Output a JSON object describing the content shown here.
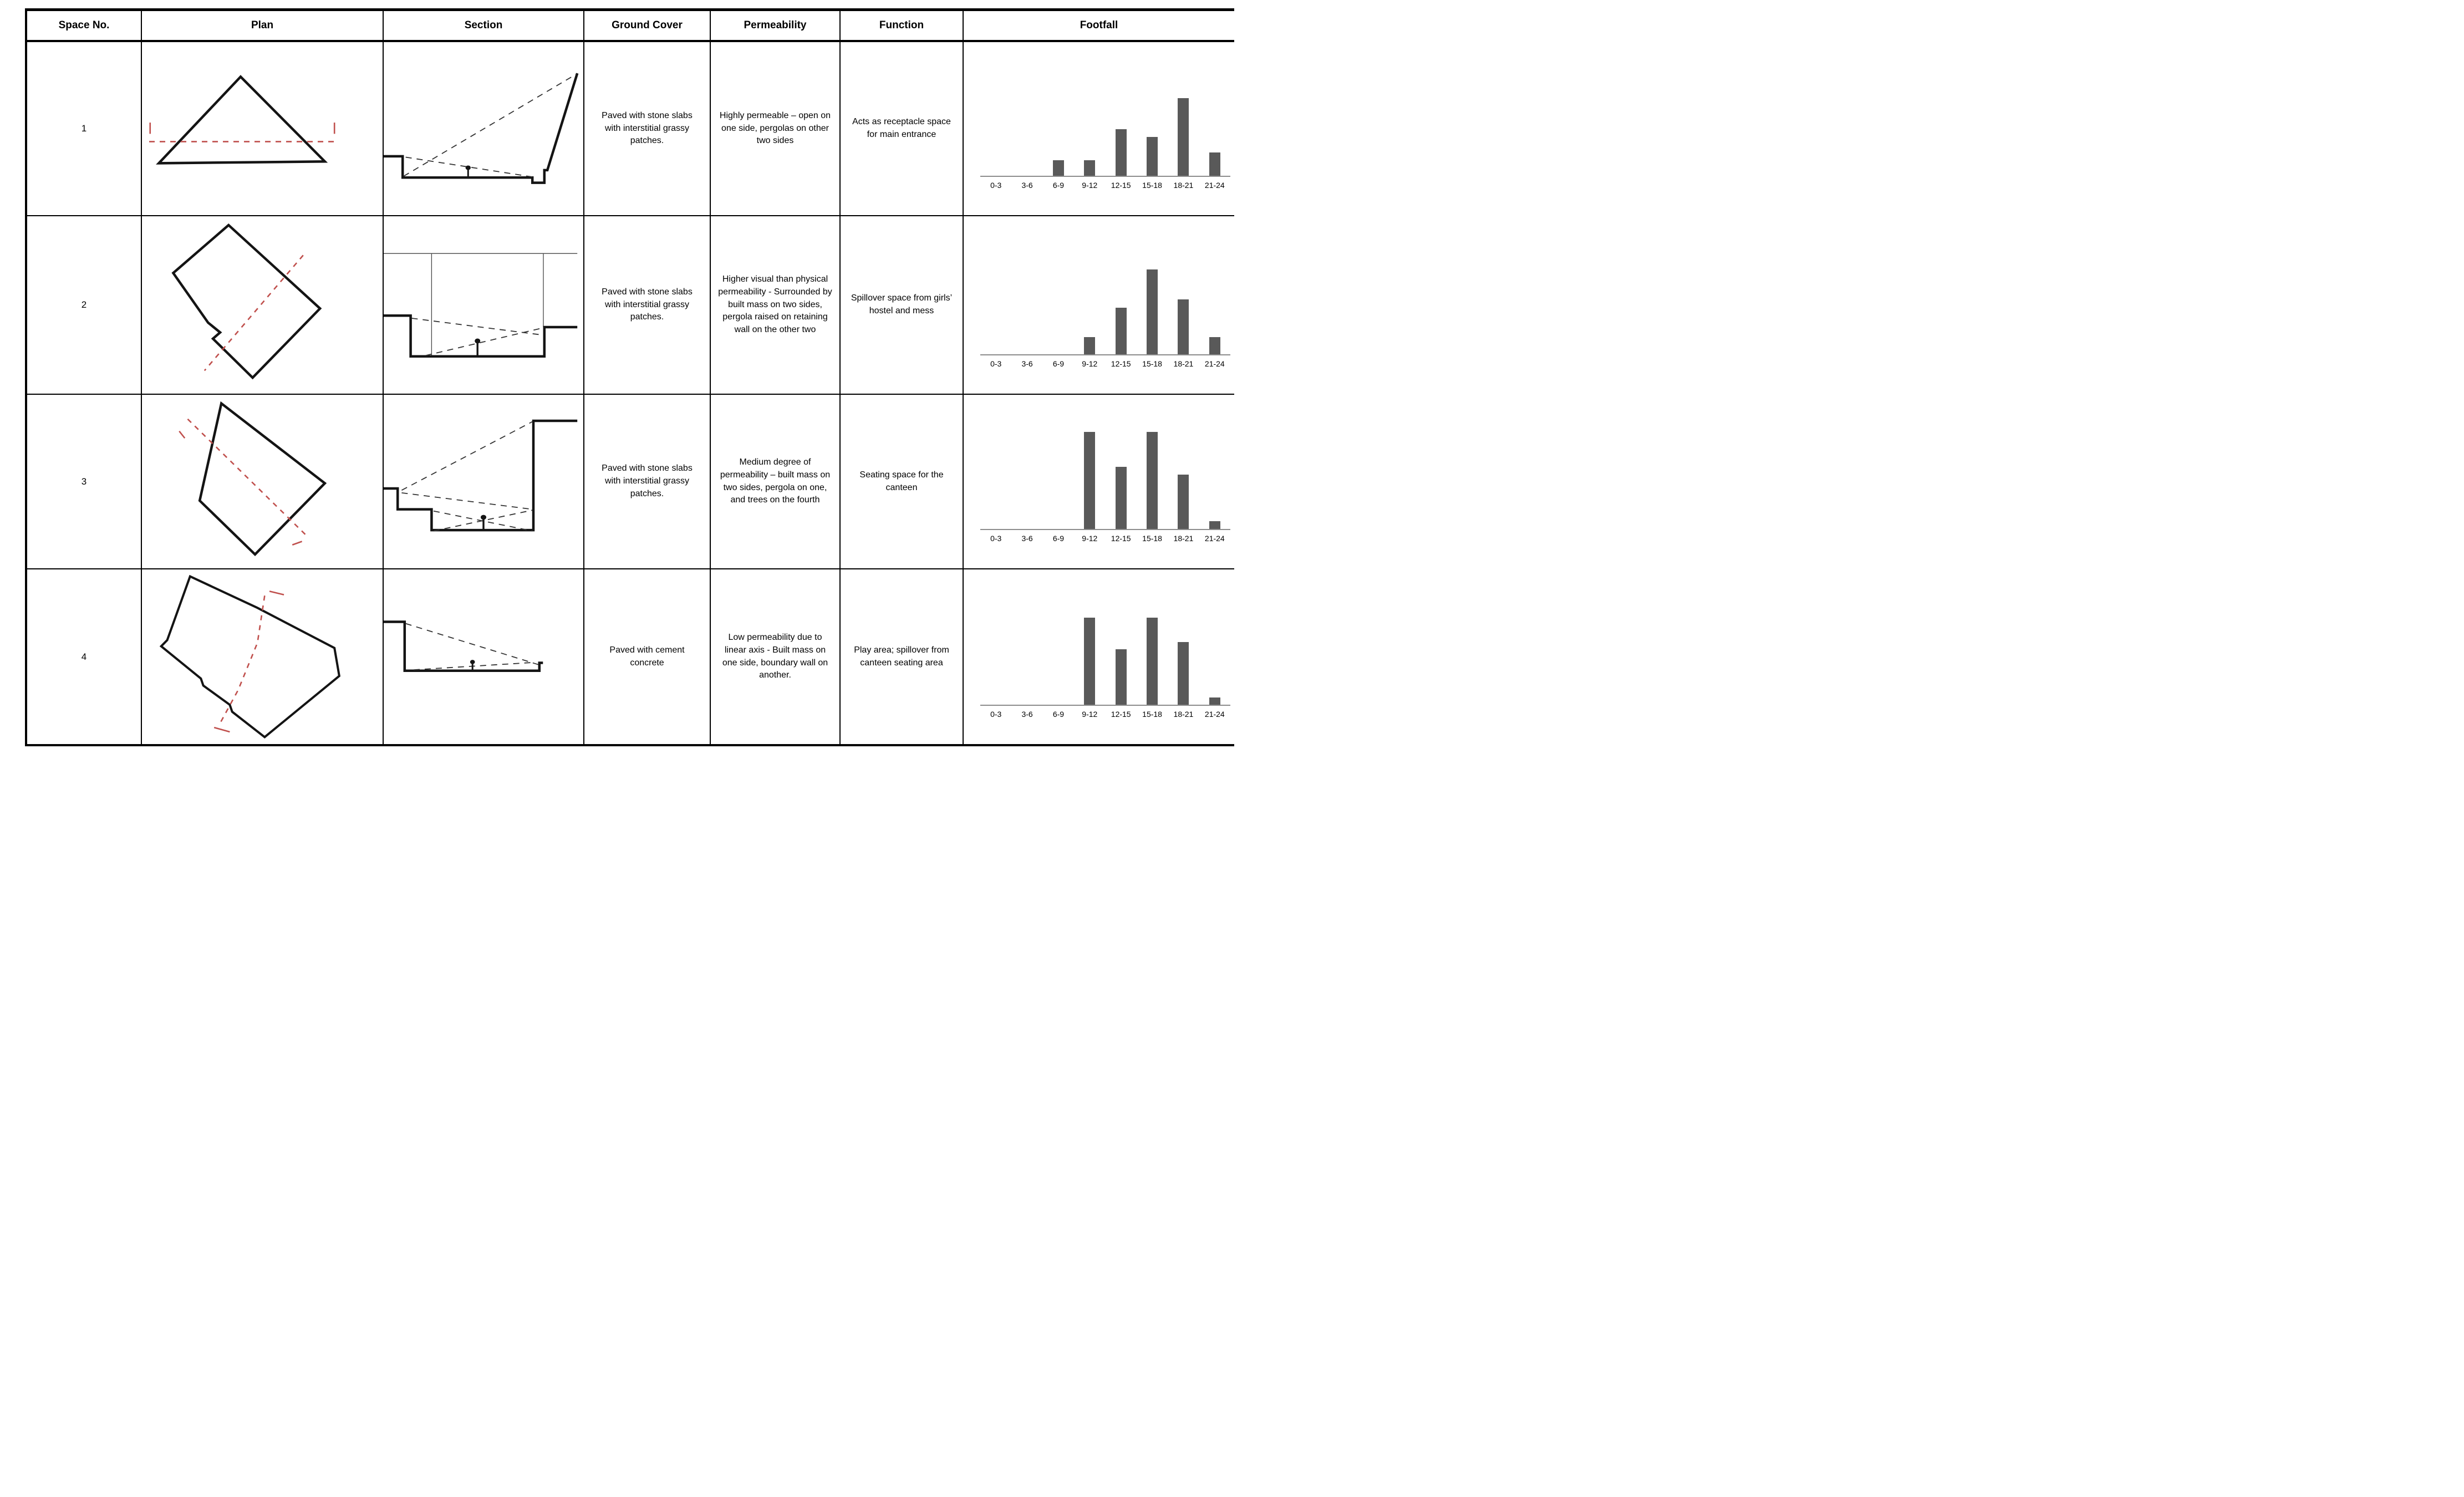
{
  "colors": {
    "diagram_line": "#141414",
    "plan_cut_red": "#c0504d",
    "bar_gray": "#595959",
    "axis_gray": "#8c8c8c"
  },
  "table": {
    "columns": [
      "Space No.",
      "Plan",
      "Section",
      "Ground Cover",
      "Permeability",
      "Function",
      "Footfall"
    ],
    "rows": [
      {
        "space_no": "1",
        "ground_cover": "Paved with stone slabs with interstitial grassy patches.",
        "permeability": "Highly permeable – open on one side, pergolas on other two sides",
        "function": "Acts as receptacle space for main entrance"
      },
      {
        "space_no": "2",
        "ground_cover": "Paved with stone slabs with interstitial grassy patches.",
        "permeability": "Higher visual than physical permeability - Surrounded by built mass on two sides, pergola raised on retaining wall on the other two",
        "function": "Spillover space from girls’ hostel and mess"
      },
      {
        "space_no": "3",
        "ground_cover": "Paved with stone slabs with interstitial grassy patches.",
        "permeability": "Medium degree of permeability – built mass on two sides, pergola on one, and trees on the fourth",
        "function": "Seating space for the canteen"
      },
      {
        "space_no": "4",
        "ground_cover": "Paved with cement concrete",
        "permeability": "Low permeability due to linear axis - Built mass on one side, boundary wall on another.",
        "function": "Play area; spillover from canteen seating area"
      }
    ]
  },
  "chart_data": [
    {
      "type": "bar",
      "space_no": "1",
      "categories": [
        "0-3",
        "3-6",
        "6-9",
        "9-12",
        "12-15",
        "15-18",
        "18-21",
        "21-24"
      ],
      "values": [
        0,
        0,
        2,
        2,
        6,
        5,
        10,
        3
      ],
      "title": "",
      "xlabel": "",
      "ylabel": "",
      "ylim": [
        0,
        10
      ],
      "grid": false,
      "legend": "none"
    },
    {
      "type": "bar",
      "space_no": "2",
      "categories": [
        "0-3",
        "3-6",
        "6-9",
        "9-12",
        "12-15",
        "15-18",
        "18-21",
        "21-24"
      ],
      "values": [
        0,
        0,
        0,
        2,
        5.5,
        10,
        6.5,
        2
      ],
      "title": "",
      "xlabel": "",
      "ylabel": "",
      "ylim": [
        0,
        10
      ],
      "grid": false,
      "legend": "none"
    },
    {
      "type": "bar",
      "space_no": "3",
      "categories": [
        "0-3",
        "3-6",
        "6-9",
        "9-12",
        "12-15",
        "15-18",
        "18-21",
        "21-24"
      ],
      "values": [
        0,
        0,
        0,
        10,
        6.4,
        10,
        5.6,
        0.8
      ],
      "title": "",
      "xlabel": "",
      "ylabel": "",
      "ylim": [
        0,
        10
      ],
      "grid": false,
      "legend": "none"
    },
    {
      "type": "bar",
      "space_no": "4",
      "categories": [
        "0-3",
        "3-6",
        "6-9",
        "9-12",
        "12-15",
        "15-18",
        "18-21",
        "21-24"
      ],
      "values": [
        0,
        0,
        0,
        10,
        6.4,
        10,
        7.2,
        0.8
      ],
      "title": "",
      "xlabel": "",
      "ylabel": "",
      "ylim": [
        0,
        10
      ],
      "grid": false,
      "legend": "none"
    }
  ]
}
